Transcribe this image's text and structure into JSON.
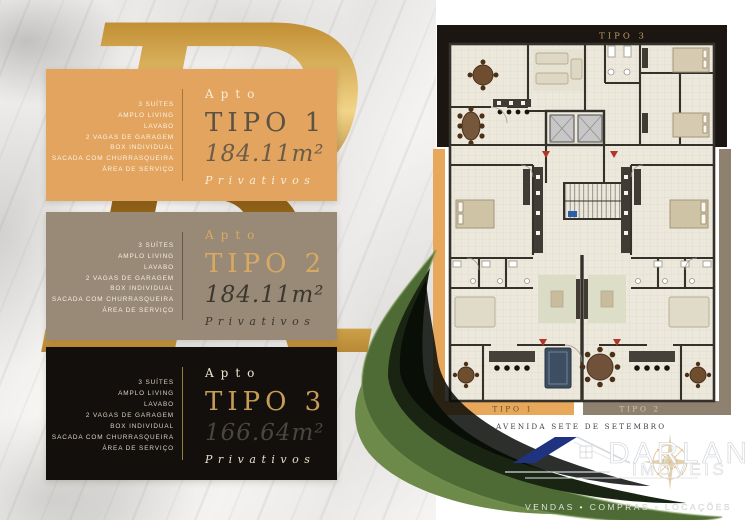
{
  "colors": {
    "card1_bg": "#E2A45E",
    "card2_bg": "#988A77",
    "card3_bg": "#130F0C",
    "gold_accent": "#C79C55",
    "plan_orange_band": "#E7A85C",
    "plan_taupe_band": "#8E8170",
    "plan_black_band": "#1B1612",
    "leaf_green": "#4E6A35",
    "logo_roof_blue": "#1F3380"
  },
  "cards": [
    {
      "apto_label": "Apto",
      "tipo_label": "TIPO 1",
      "area_value": "184.11m²",
      "privativos_label": "Privativos",
      "features": [
        "3 SUÍTES",
        "AMPLO LIVING",
        "LAVABO",
        "2 VAGAS DE GARAGEM",
        "BOX INDIVIDUAL",
        "SACADA COM CHURRASQUEIRA",
        "ÁREA DE SERVIÇO"
      ]
    },
    {
      "apto_label": "Apto",
      "tipo_label": "TIPO 2",
      "area_value": "184.11m²",
      "privativos_label": "Privativos",
      "features": [
        "3 SUÍTES",
        "AMPLO LIVING",
        "LAVABO",
        "2 VAGAS DE GARAGEM",
        "BOX INDIVIDUAL",
        "SACADA COM CHURRASQUEIRA",
        "ÁREA DE SERVIÇO"
      ]
    },
    {
      "apto_label": "Apto",
      "tipo_label": "TIPO 3",
      "area_value": "166.64m²",
      "privativos_label": "Privativos",
      "features": [
        "3 SUÍTES",
        "AMPLO LIVING",
        "LAVABO",
        "2 VAGAS DE GARAGEM",
        "BOX INDIVIDUAL",
        "SACADA COM CHURRASQUEIRA",
        "ÁREA DE SERVIÇO"
      ]
    }
  ],
  "floorplan": {
    "top_label": "TIPO 3",
    "bottom_left_label": "TIPO 1",
    "bottom_right_label": "TIPO 2"
  },
  "footer": {
    "address_label": "AVENIDA SETE DE SETEMBRO",
    "brand_name": "DARLAN",
    "brand_subtitle": "IMÓVEIS",
    "tagline": "VENDAS • COMPRAS • LOCAÇÕES"
  }
}
